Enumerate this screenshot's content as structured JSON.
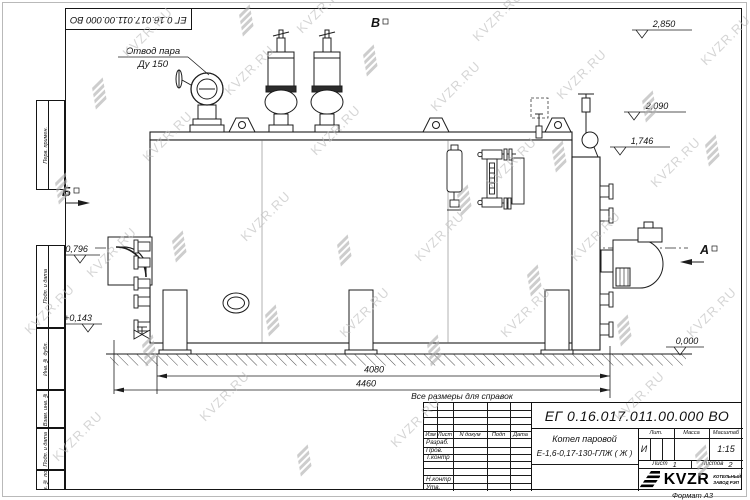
{
  "watermark": {
    "text": "KVZR.RU"
  },
  "top_stamp": {
    "doc_number": "ЕГ 0.16.017.011.00.000  ВО"
  },
  "margin": {
    "perv": "Перв. примен.",
    "podp1": "Подп. и дата",
    "inv_dubl": "Инв. № дубл.",
    "vzam": "Взам. инв. №",
    "podp2": "Подп. и дата",
    "inv_podl": "Инв. № подл."
  },
  "drawing": {
    "annotations": {
      "steam_line1": "Отвод пара",
      "steam_line2": "Ду 150",
      "ref_note": "Все размеры для справок"
    },
    "view_labels": {
      "b": "Б",
      "v": "В",
      "a": "А"
    },
    "elevations": {
      "e1": "2,850",
      "e2": "2,090",
      "e3": "1,746",
      "e4": "+0,796",
      "e5": "+0,143",
      "e6": "0,000"
    },
    "dimensions": {
      "d1": "4080",
      "d2": "4460"
    }
  },
  "title_block": {
    "doc_number": "ЕГ 0.16.017.011.00.000  ВО",
    "product_name_line1": "Котел паровой",
    "product_name_line2": "Е-1,6-0,17-130-ГЛЖ ( Ж )",
    "change_headers": {
      "izm": "Изм",
      "list": "Лист",
      "doc": "N докум",
      "podp": "Подп",
      "date": "Дата"
    },
    "sign_rows": {
      "r1": "Разраб.",
      "r2": "Пров.",
      "r3": "Т.контр",
      "r4": "Н.контр",
      "r5": "Утв."
    },
    "lit_label": "Лит.",
    "mass_label": "Масса",
    "scale_label": "Масштаб",
    "lit_value": "И",
    "scale_value": "1:15",
    "sheet_label": "Лист",
    "sheet_number": "1",
    "sheets_label": "Листов",
    "sheets_total": "2",
    "logo_text": "KVZR",
    "logo_caption_line1": "КОТЕЛЬНЫЙ",
    "logo_caption_line2": "ЗАВОД РЭП",
    "format_label": "Формат А3"
  }
}
